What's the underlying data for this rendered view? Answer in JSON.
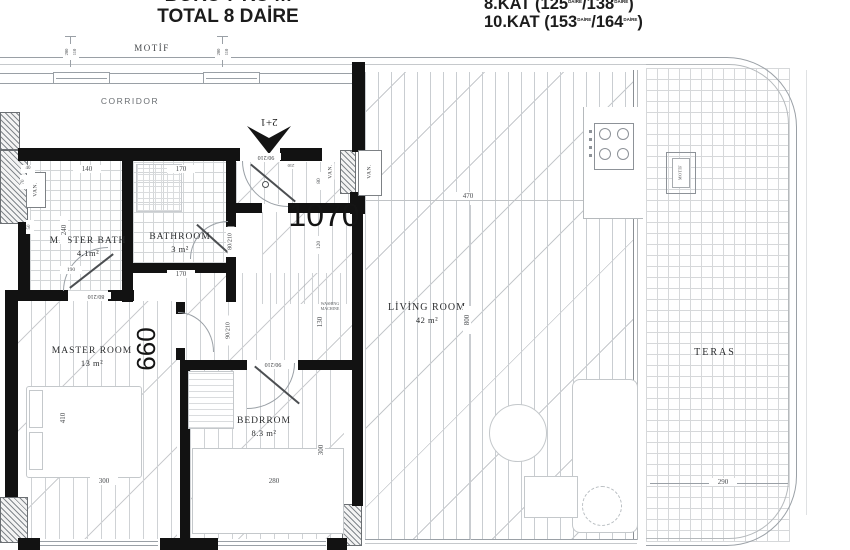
{
  "header": {
    "top_line_partial": "BÖRÜ 7 KÜ m",
    "total": "TOTAL 8 DAİRE",
    "kat1": {
      "a": "8.KAT (125",
      "s1": "DAİRE",
      "b": "/138",
      "s2": "DAİRE",
      "c": ")"
    },
    "kat2": {
      "a": "10.KAT (153",
      "s1": "DAİRE",
      "b": "/164",
      "s2": "DAİRE",
      "c": ")"
    }
  },
  "band": {
    "motif": "MOTİF",
    "corridor": "CORRIDOR",
    "tick_outer": "200",
    "tick_inner": "110"
  },
  "rooms": {
    "master_bath": {
      "name": "MASTER BATH",
      "area": "4.1m²"
    },
    "bathroom": {
      "name": "BATHROOM",
      "area": "3 m²"
    },
    "master_room": {
      "name": "MASTER ROOM",
      "area": "13 m²"
    },
    "bedroom": {
      "name": "BEDRROM",
      "area": "8.3 m²"
    },
    "living_room": {
      "name": "LİVİNG ROOM",
      "area": "42 m²"
    },
    "terrace": {
      "name": "TERAS"
    }
  },
  "numbers": {
    "hall": "1070",
    "master_room": "660",
    "unit_type": "2+1"
  },
  "doors": {
    "entrance": "90/210",
    "entrance_w": "210",
    "master_bath": "80/210",
    "bathroom": "80/210",
    "hall": "90/210",
    "bedroom": "90/210"
  },
  "dims": {
    "mb_top": "140",
    "bath_top": "170",
    "bath_bottom": "170",
    "mb_height": "240",
    "mb_40": "40",
    "mb_70": "70",
    "mb_50": "50",
    "mb_190": "190",
    "shaft_80": "80",
    "shaft_120": "120",
    "hall_130": "130",
    "bed_w": "280",
    "bed_h": "300",
    "master_w": "300",
    "master_h": "410",
    "living_w": "470",
    "living_h": "800",
    "teras_w": "290"
  },
  "small": {
    "van": "VAN.",
    "washing_1": "WASHING",
    "washing_2": "MACHINE",
    "teras_marker": "MOTİF"
  },
  "colors": {
    "wall": "#121212",
    "line": "#9aa0a6"
  }
}
